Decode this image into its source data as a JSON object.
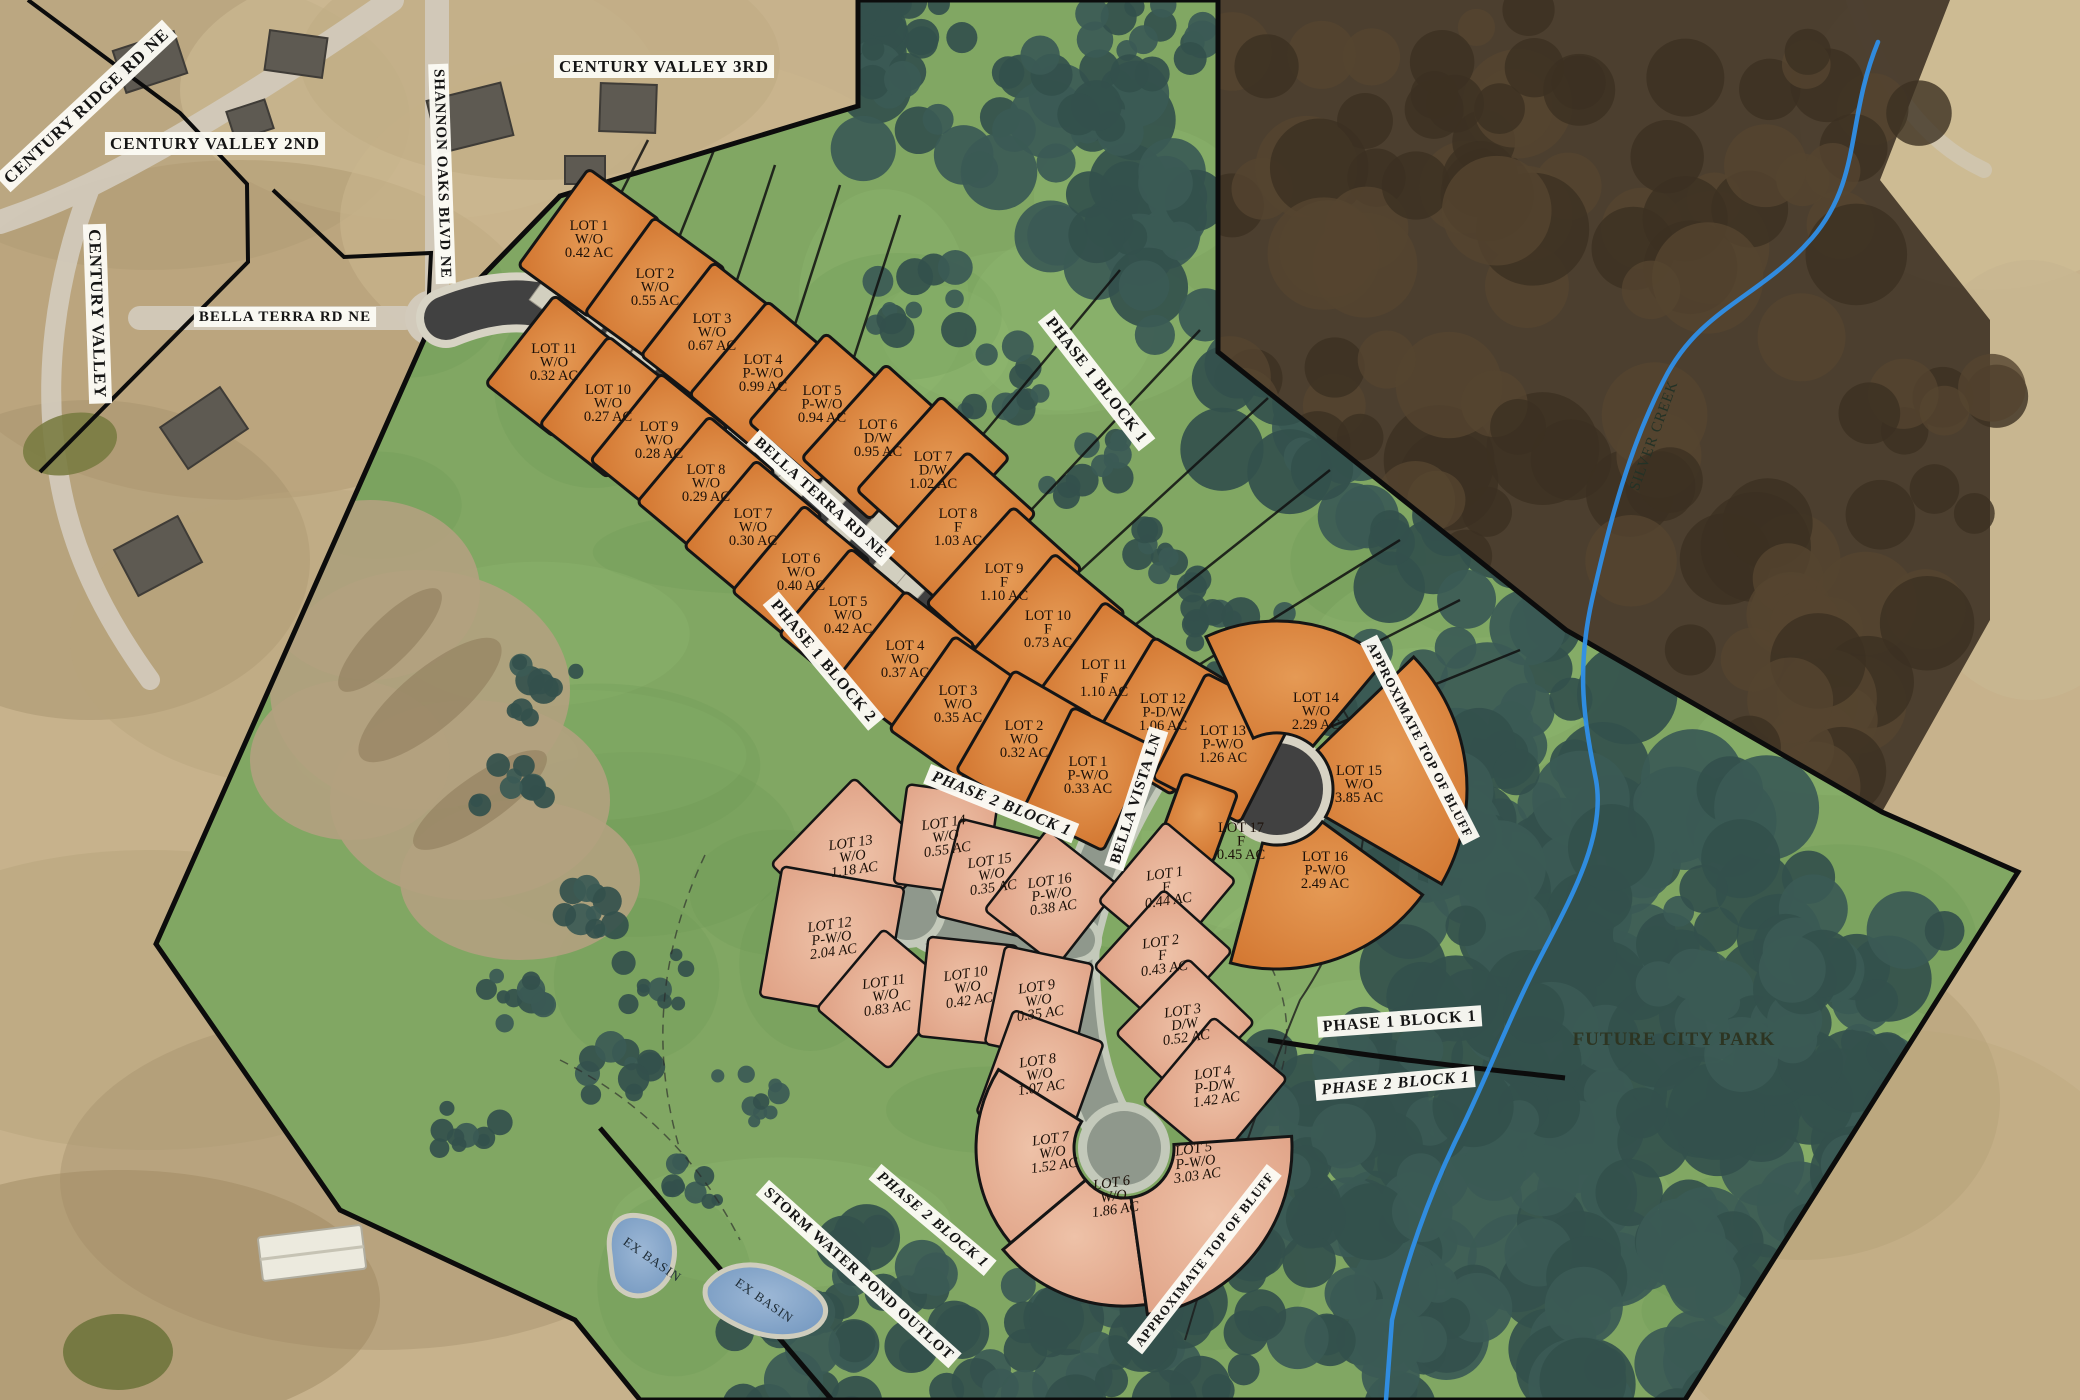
{
  "map": {
    "colors": {
      "orange_lot": "#d2752f",
      "orange_lot_hi": "#e59a55",
      "pink_lot": "#dfa084",
      "pink_lot_hi": "#eec2a8",
      "site_green": "#81a763",
      "tree_green": "#33504c",
      "woods_brown": "#46392a",
      "road_dark": "#414141",
      "road_proposed": "#8f988c",
      "sidewalk": "#d7d3c4",
      "pad": "#d2cfbf",
      "creek_blue": "#2f8fe8",
      "basin_blue": "#6f94bd",
      "tan": "#c7b28c",
      "boundary": "#0c0c0c",
      "label_bg": "#fbfaf4",
      "label_text": "#141414"
    },
    "labels": [
      {
        "id": "century-ridge-rd",
        "text": "CENTURY RIDGE RD NE",
        "x": 90,
        "y": 110,
        "rot": -43,
        "style": "box",
        "size": 17
      },
      {
        "id": "century-valley-2nd",
        "text": "CENTURY VALLEY 2ND",
        "x": 215,
        "y": 149,
        "rot": 0,
        "style": "box",
        "size": 17
      },
      {
        "id": "century-valley",
        "text": "CENTURY VALLEY",
        "x": 92,
        "y": 314,
        "rot": 88,
        "style": "box",
        "size": 17
      },
      {
        "id": "bella-terra-rd-west",
        "text": "BELLA TERRA RD NE",
        "x": 285,
        "y": 321,
        "rot": 0,
        "style": "box",
        "size": 15
      },
      {
        "id": "shannon-oaks-blvd",
        "text": "SHANNON OAKS BLVD NE",
        "x": 438,
        "y": 174,
        "rot": 88,
        "style": "box",
        "size": 15
      },
      {
        "id": "century-valley-3rd",
        "text": "CENTURY VALLEY 3RD",
        "x": 664,
        "y": 72,
        "rot": 0,
        "style": "box",
        "size": 17
      },
      {
        "id": "phase1-block1-top",
        "text": "PHASE 1  BLOCK 1",
        "x": 1093,
        "y": 383,
        "rot": 52,
        "style": "box",
        "size": 16
      },
      {
        "id": "bella-terra-rd-onroad",
        "text": "BELLA TERRA RD NE",
        "x": 818,
        "y": 501,
        "rot": 42,
        "style": "box",
        "size": 15
      },
      {
        "id": "phase1-block2",
        "text": "PHASE 1  BLOCK 2",
        "x": 820,
        "y": 664,
        "rot": 50,
        "style": "box",
        "size": 16
      },
      {
        "id": "phase2-block1-main",
        "text": "PHASE 2  BLOCK 1",
        "x": 1000,
        "y": 808,
        "rot": 22,
        "style": "box",
        "size": 16,
        "italic": true
      },
      {
        "id": "bella-vista-ln",
        "text": "BELLA VISTA LN",
        "x": 1140,
        "y": 800,
        "rot": -72,
        "style": "box",
        "size": 15
      },
      {
        "id": "approx-top-of-bluff-right",
        "text": "APPROXIMATE TOP OF BLUFF",
        "x": 1416,
        "y": 742,
        "rot": 63,
        "style": "box",
        "size": 13
      },
      {
        "id": "phase1-block1-right",
        "text": "PHASE 1  BLOCK 1",
        "x": 1400,
        "y": 1026,
        "rot": -4,
        "style": "box",
        "size": 16
      },
      {
        "id": "phase2-block1-right",
        "text": "PHASE 2  BLOCK 1",
        "x": 1396,
        "y": 1088,
        "rot": -5,
        "style": "box",
        "size": 16,
        "italic": true
      },
      {
        "id": "future-city-park",
        "text": "FUTURE CITY PARK",
        "x": 1674,
        "y": 1045,
        "rot": 0,
        "style": "park",
        "size": 19
      },
      {
        "id": "phase2-block1-bottom",
        "text": "PHASE 2  BLOCK 1",
        "x": 930,
        "y": 1223,
        "rot": 40,
        "style": "box",
        "size": 15,
        "italic": true
      },
      {
        "id": "storm-water-pond-outlot",
        "text": "STORM WATER POND OUTLOT",
        "x": 856,
        "y": 1277,
        "rot": 42,
        "style": "box",
        "size": 15
      },
      {
        "id": "ex-basin-1",
        "text": "EX BASIN",
        "x": 650,
        "y": 1263,
        "rot": 35,
        "style": "water",
        "size": 13
      },
      {
        "id": "ex-basin-2",
        "text": "EX BASIN",
        "x": 762,
        "y": 1304,
        "rot": 35,
        "style": "water",
        "size": 13
      },
      {
        "id": "approx-top-of-bluff-bottom",
        "text": "APPROXIMATE TOP  OF BLUFF",
        "x": 1208,
        "y": 1262,
        "rot": -52,
        "style": "box",
        "size": 13
      },
      {
        "id": "silver-creek",
        "text": "SILVER CREEK",
        "x": 1658,
        "y": 437,
        "rot": -70,
        "style": "creek",
        "size": 15
      }
    ],
    "blocks": [
      {
        "block": "PHASE 1 BLOCK 1",
        "palette": "orange",
        "lots": [
          {
            "name": "LOT 1",
            "type": "W/O",
            "area": "0.42 AC",
            "shape": "rect",
            "x": 589,
            "y": 243,
            "w": 88,
            "h": 120,
            "rot": 36,
            "side": "ne"
          },
          {
            "name": "LOT 2",
            "type": "W/O",
            "area": "0.55 AC",
            "shape": "rect",
            "x": 655,
            "y": 291,
            "w": 88,
            "h": 118,
            "rot": 36,
            "side": "ne"
          },
          {
            "name": "LOT 3",
            "type": "W/O",
            "area": "0.67 AC",
            "shape": "rect",
            "x": 712,
            "y": 336,
            "w": 88,
            "h": 118,
            "rot": 38,
            "side": "ne"
          },
          {
            "name": "LOT 4",
            "type": "P-W/O",
            "area": "0.99 AC",
            "shape": "rect",
            "x": 763,
            "y": 377,
            "w": 90,
            "h": 122,
            "rot": 40,
            "side": "ne"
          },
          {
            "name": "LOT 5",
            "type": "P-W/O",
            "area": "0.94 AC",
            "shape": "rect",
            "x": 822,
            "y": 408,
            "w": 92,
            "h": 118,
            "rot": 41,
            "side": "ne"
          },
          {
            "name": "LOT 6",
            "type": "D/W",
            "area": "0.95 AC",
            "shape": "rect",
            "x": 878,
            "y": 442,
            "w": 92,
            "h": 126,
            "rot": 42,
            "side": "ne"
          },
          {
            "name": "LOT 7",
            "type": "D/W",
            "area": "1.02 AC",
            "shape": "rect",
            "x": 933,
            "y": 474,
            "w": 92,
            "h": 126,
            "rot": 42,
            "side": "ne"
          },
          {
            "name": "LOT 8",
            "type": "F",
            "area": "1.03 AC",
            "shape": "rect",
            "x": 958,
            "y": 531,
            "w": 92,
            "h": 130,
            "rot": 42,
            "side": "ne"
          },
          {
            "name": "LOT 9",
            "type": "F",
            "area": "1.10 AC",
            "shape": "rect",
            "x": 1004,
            "y": 586,
            "w": 92,
            "h": 130,
            "rot": 42,
            "side": "ne"
          },
          {
            "name": "LOT 10",
            "type": "F",
            "area": "0.73 AC",
            "shape": "rect",
            "x": 1048,
            "y": 633,
            "w": 92,
            "h": 130,
            "rot": 40,
            "side": "ne"
          },
          {
            "name": "LOT 11",
            "type": "F",
            "area": "1.10 AC",
            "shape": "rect",
            "x": 1104,
            "y": 682,
            "w": 94,
            "h": 130,
            "rot": 36,
            "side": "ne"
          },
          {
            "name": "LOT 12",
            "type": "P-D/W",
            "area": "1.06 AC",
            "shape": "rect",
            "x": 1163,
            "y": 716,
            "w": 96,
            "h": 126,
            "rot": 31,
            "side": "ne"
          },
          {
            "name": "LOT 13",
            "type": "P-W/O",
            "area": "1.26 AC",
            "shape": "rect",
            "x": 1223,
            "y": 748,
            "w": 98,
            "h": 118,
            "rot": 27,
            "side": "ne"
          },
          {
            "name": "LOT 14",
            "type": "W/O",
            "area": "2.29 AC",
            "shape": "sector",
            "cx": 1277,
            "cy": 789,
            "r1": 56,
            "r2": 168,
            "a1": -115,
            "a2": -50,
            "lx": 1316,
            "ly": 715
          },
          {
            "name": "LOT 15",
            "type": "W/O",
            "area": "3.85 AC",
            "shape": "sector",
            "cx": 1277,
            "cy": 789,
            "r1": 56,
            "r2": 190,
            "a1": -44,
            "a2": 30,
            "lx": 1359,
            "ly": 788
          },
          {
            "name": "LOT 16",
            "type": "P-W/O",
            "area": "2.49 AC",
            "shape": "sector",
            "cx": 1277,
            "cy": 789,
            "r1": 56,
            "r2": 180,
            "a1": 36,
            "a2": 105,
            "lx": 1325,
            "ly": 874
          },
          {
            "name": "LOT 17",
            "type": "F",
            "area": "0.45 AC",
            "shape": "rect",
            "x": 1198,
            "y": 818,
            "w": 58,
            "h": 74,
            "rot": 20,
            "lx": 1241,
            "ly": 845,
            "plain": true
          }
        ]
      },
      {
        "block": "PHASE 1 BLOCK 2",
        "palette": "orange",
        "lots": [
          {
            "name": "LOT 11",
            "type": "W/O",
            "area": "0.32 AC",
            "shape": "rect",
            "x": 554,
            "y": 366,
            "w": 86,
            "h": 112,
            "rot": 38,
            "side": "sw"
          },
          {
            "name": "LOT 10",
            "type": "W/O",
            "area": "0.27 AC",
            "shape": "rect",
            "x": 608,
            "y": 407,
            "w": 86,
            "h": 112,
            "rot": 38,
            "side": "sw"
          },
          {
            "name": "LOT 9",
            "type": "W/O",
            "area": "0.28 AC",
            "shape": "rect",
            "x": 659,
            "y": 444,
            "w": 86,
            "h": 112,
            "rot": 39,
            "side": "sw"
          },
          {
            "name": "LOT 8",
            "type": "W/O",
            "area": "0.29 AC",
            "shape": "rect",
            "x": 706,
            "y": 487,
            "w": 86,
            "h": 112,
            "rot": 40,
            "side": "sw"
          },
          {
            "name": "LOT 7",
            "type": "W/O",
            "area": "0.30 AC",
            "shape": "rect",
            "x": 753,
            "y": 531,
            "w": 86,
            "h": 112,
            "rot": 40,
            "side": "sw"
          },
          {
            "name": "LOT 6",
            "type": "W/O",
            "area": "0.40 AC",
            "shape": "rect",
            "x": 801,
            "y": 576,
            "w": 86,
            "h": 112,
            "rot": 40,
            "side": "sw"
          },
          {
            "name": "LOT 5",
            "type": "W/O",
            "area": "0.42 AC",
            "shape": "rect",
            "x": 848,
            "y": 619,
            "w": 86,
            "h": 112,
            "rot": 40,
            "side": "sw"
          },
          {
            "name": "LOT 4",
            "type": "W/O",
            "area": "0.37 AC",
            "shape": "rect",
            "x": 905,
            "y": 663,
            "w": 88,
            "h": 114,
            "rot": 38,
            "side": "sw"
          },
          {
            "name": "LOT 3",
            "type": "W/O",
            "area": "0.35 AC",
            "shape": "rect",
            "x": 958,
            "y": 708,
            "w": 88,
            "h": 114,
            "rot": 35,
            "side": "sw"
          },
          {
            "name": "LOT 2",
            "type": "W/O",
            "area": "0.32 AC",
            "shape": "rect",
            "x": 1024,
            "y": 743,
            "w": 90,
            "h": 116,
            "rot": 30,
            "side": "sw"
          },
          {
            "name": "LOT 1",
            "type": "P-W/O",
            "area": "0.33 AC",
            "shape": "rect",
            "x": 1088,
            "y": 779,
            "w": 90,
            "h": 116,
            "rot": 26,
            "side": "sw"
          }
        ]
      },
      {
        "block": "PHASE 2 BLOCK 1",
        "palette": "pink",
        "lots": [
          {
            "name": "LOT 13",
            "type": "W/O",
            "area": "1.18 AC",
            "shape": "rect",
            "x": 853,
            "y": 860,
            "w": 112,
            "h": 120,
            "rot": 44
          },
          {
            "name": "LOT 14",
            "type": "W/O",
            "area": "0.55 AC",
            "shape": "rect",
            "x": 946,
            "y": 840,
            "w": 92,
            "h": 100,
            "rot": 8
          },
          {
            "name": "LOT 15",
            "type": "W/O",
            "area": "0.35 AC",
            "shape": "rect",
            "x": 992,
            "y": 878,
            "w": 90,
            "h": 100,
            "rot": 14
          },
          {
            "name": "LOT 16",
            "type": "P-W/O",
            "area": "0.38 AC",
            "shape": "rect",
            "x": 1052,
            "y": 898,
            "w": 92,
            "h": 102,
            "rot": 38
          },
          {
            "name": "LOT 12",
            "type": "P-W/O",
            "area": "2.04 AC",
            "shape": "rect",
            "x": 832,
            "y": 942,
            "w": 124,
            "h": 132,
            "rot": 10
          },
          {
            "name": "LOT 11",
            "type": "W/O",
            "area": "0.83 AC",
            "shape": "rect",
            "x": 886,
            "y": 999,
            "w": 94,
            "h": 104,
            "rot": 40
          },
          {
            "name": "LOT 10",
            "type": "W/O",
            "area": "0.42 AC",
            "shape": "rect",
            "x": 968,
            "y": 991,
            "w": 90,
            "h": 100,
            "rot": 6
          },
          {
            "name": "LOT 9",
            "type": "W/O",
            "area": "0.35 AC",
            "shape": "rect",
            "x": 1039,
            "y": 1004,
            "w": 90,
            "h": 100,
            "rot": 12
          },
          {
            "name": "LOT 1",
            "type": "F",
            "area": "0.44 AC",
            "shape": "rect",
            "x": 1167,
            "y": 891,
            "w": 92,
            "h": 104,
            "rot": 40
          },
          {
            "name": "LOT 2",
            "type": "F",
            "area": "0.43 AC",
            "shape": "rect",
            "x": 1163,
            "y": 959,
            "w": 92,
            "h": 104,
            "rot": 42
          },
          {
            "name": "LOT 3",
            "type": "D/W",
            "area": "0.52 AC",
            "shape": "rect",
            "x": 1185,
            "y": 1028,
            "w": 92,
            "h": 104,
            "rot": 44
          },
          {
            "name": "LOT 4",
            "type": "P-D/W",
            "area": "1.42 AC",
            "shape": "rect",
            "x": 1215,
            "y": 1090,
            "w": 96,
            "h": 110,
            "rot": 40
          },
          {
            "name": "LOT 8",
            "type": "W/O",
            "area": "1.07 AC",
            "shape": "rect",
            "x": 1040,
            "y": 1078,
            "w": 96,
            "h": 110,
            "rot": 20
          },
          {
            "name": "LOT 7",
            "type": "W/O",
            "area": "1.52 AC",
            "shape": "sector",
            "cx": 1124,
            "cy": 1148,
            "r1": 50,
            "r2": 148,
            "a1": 140,
            "a2": 212,
            "lx": 1053,
            "ly": 1156
          },
          {
            "name": "LOT 6",
            "type": "W/O",
            "area": "1.86 AC",
            "shape": "sector",
            "cx": 1124,
            "cy": 1148,
            "r1": 50,
            "r2": 158,
            "a1": 82,
            "a2": 140,
            "lx": 1114,
            "ly": 1200
          },
          {
            "name": "LOT 5",
            "type": "P-W/O",
            "area": "3.03 AC",
            "shape": "sector",
            "cx": 1124,
            "cy": 1148,
            "r1": 50,
            "r2": 168,
            "a1": -4,
            "a2": 82,
            "lx": 1196,
            "ly": 1166
          }
        ]
      }
    ]
  }
}
